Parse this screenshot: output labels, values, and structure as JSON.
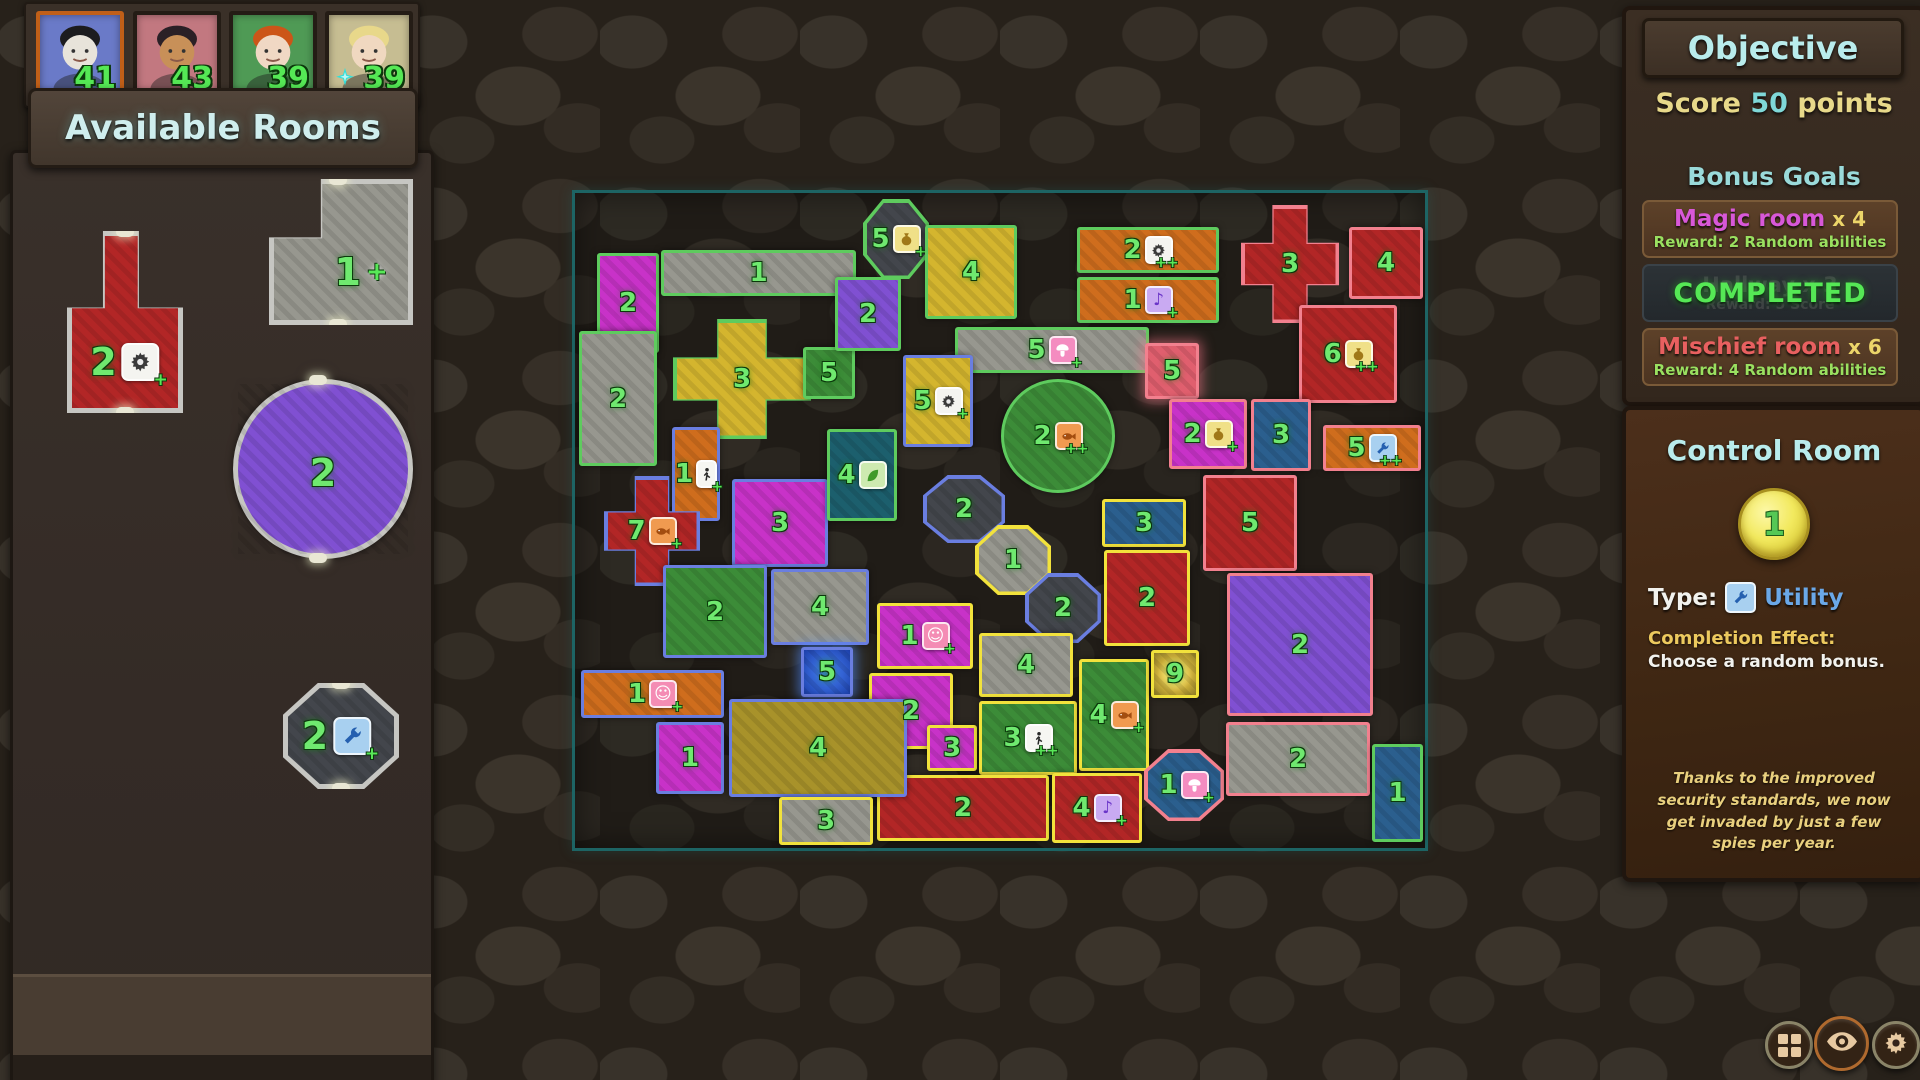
{
  "palette": {
    "floor": {
      "magenta": "#c832c8",
      "gray": "#97978f",
      "yellow": "#d4b52e",
      "treasure": "#a8922a",
      "green": "#3c8c38",
      "orange": "#cf6d1d",
      "red": "#b22626",
      "blue": "#2b5f8e",
      "teal": "#1c5f6d",
      "purple": "#8050d2",
      "dark": "#43464c",
      "pinkGlow": "#e05f6e",
      "blueGlow": "#2a5fd8",
      "gold": "#a08c2a"
    },
    "border": {
      "green": "#5ecb5e",
      "blue": "#6a7ee0",
      "yellow": "#f2e23c",
      "pink": "#f2808e",
      "gray": "#c6c6c2",
      "map": "#1d6464"
    },
    "number": "#6fe96f"
  },
  "hud": {
    "players": [
      {
        "label": "player-1",
        "score": "41",
        "bg": "#6a7ac8",
        "hair": "#1c1c1e",
        "skin": "#e8e4da",
        "frame": "#c05f18",
        "active": true,
        "turn_icon": ""
      },
      {
        "label": "player-2",
        "score": "43",
        "bg": "#c27880",
        "hair": "#2a2026",
        "skin": "#c89058",
        "frame": "#241c15",
        "active": false,
        "turn_icon": ""
      },
      {
        "label": "player-3",
        "score": "39",
        "bg": "#4f9a55",
        "hair": "#cc5518",
        "skin": "#f0d8c4",
        "frame": "#241c15",
        "active": false,
        "turn_icon": ""
      },
      {
        "label": "player-4",
        "score": "39",
        "bg": "#c6bd92",
        "hair": "#e8d88a",
        "skin": "#f0d8c0",
        "frame": "#241c15",
        "active": false,
        "turn_icon": "turn-star"
      }
    ]
  },
  "available_rooms": {
    "title": "Available Rooms",
    "rooms": [
      {
        "shape": "tshape",
        "floor": "red",
        "num": "2",
        "icon": "gear",
        "plus": "+",
        "x": 64,
        "y": 228,
        "w": 116,
        "h": 182,
        "lx": 50,
        "ly": 72
      },
      {
        "shape": "lshape",
        "floor": "gray",
        "num": "1",
        "icon": "plus",
        "plus": "",
        "x": 266,
        "y": 176,
        "w": 144,
        "h": 146,
        "lx": 64,
        "ly": 64
      },
      {
        "shape": "circle",
        "floor": "purple",
        "num": "2",
        "icon": "",
        "plus": "",
        "x": 230,
        "y": 376,
        "w": 180,
        "h": 180,
        "lx": 50,
        "ly": 52
      },
      {
        "shape": "octagon",
        "floor": "dark",
        "num": "2",
        "icon": "wrench",
        "plus": "+",
        "x": 280,
        "y": 680,
        "w": 116,
        "h": 106,
        "lx": 46,
        "ly": 50
      }
    ]
  },
  "objective": {
    "title": "Objective",
    "score_goal": [
      {
        "text": "Score ",
        "color": "#e8d98a"
      },
      {
        "text": "50",
        "color": "#7fd8d8"
      },
      {
        "text": " points",
        "color": "#e8d98a"
      }
    ],
    "bonus_title": "Bonus Goals",
    "goals": [
      {
        "type": "goal",
        "name": "Magic room",
        "name_color": "#d858d8",
        "count": "x 4",
        "reward": "Reward: 2 Random abilities"
      },
      {
        "type": "completed",
        "label": "COMPLETED",
        "ghost_name": "Hallway x 3",
        "ghost_reward": "Reward: 5 Score"
      },
      {
        "type": "goal",
        "name": "Mischief room",
        "name_color": "#e86060",
        "count": "x 6",
        "reward": "Reward: 4 Random abilities"
      }
    ]
  },
  "control_room": {
    "title": "Control Room",
    "level": "1",
    "type_label": "Type:",
    "type_icon": "wrench",
    "type_value": "Utility",
    "effect_label": "Completion Effect:",
    "effect_text": "Choose a random bonus.",
    "flavor": "Thanks to the improved security standards, we now get invaded by just a few spies per year."
  },
  "toolbar": {
    "buttons": [
      {
        "icon": "grid",
        "label": "rooms-grid-button",
        "ring": "#8a8468",
        "x": 1765,
        "y": 1021,
        "d": 48
      },
      {
        "icon": "eye",
        "label": "vision-button",
        "ring": "#b06a2e",
        "x": 1814,
        "y": 1016,
        "d": 55
      },
      {
        "icon": "gear",
        "label": "settings-button",
        "ring": "#8a8468",
        "x": 1872,
        "y": 1021,
        "d": 48
      }
    ]
  },
  "map": {
    "rooms": [
      {
        "n": "2",
        "x": 22,
        "y": 60,
        "w": 62,
        "h": 100,
        "f": "magenta",
        "b": "green",
        "s": "rect",
        "i": "",
        "p": ""
      },
      {
        "n": "1",
        "x": 86,
        "y": 57,
        "w": 195,
        "h": 46,
        "f": "gray",
        "b": "green",
        "s": "rect",
        "i": "",
        "p": ""
      },
      {
        "n": "2",
        "x": 4,
        "y": 138,
        "w": 78,
        "h": 135,
        "f": "gray",
        "b": "green",
        "s": "rect",
        "i": "",
        "p": ""
      },
      {
        "n": "3",
        "x": 98,
        "y": 126,
        "w": 138,
        "h": 120,
        "f": "yellow",
        "b": "green",
        "s": "cross",
        "i": "",
        "p": ""
      },
      {
        "n": "5",
        "x": 228,
        "y": 154,
        "w": 52,
        "h": 52,
        "f": "green",
        "b": "green",
        "s": "rect",
        "i": "",
        "p": ""
      },
      {
        "n": "2",
        "x": 260,
        "y": 84,
        "w": 66,
        "h": 74,
        "f": "purple",
        "b": "green",
        "s": "rect",
        "i": "",
        "p": ""
      },
      {
        "n": "5",
        "x": 288,
        "y": 6,
        "w": 66,
        "h": 80,
        "f": "dark",
        "b": "green",
        "s": "octagon",
        "i": "pot",
        "p": "+"
      },
      {
        "n": "4",
        "x": 350,
        "y": 32,
        "w": 92,
        "h": 94,
        "f": "yellow",
        "b": "green",
        "s": "rect",
        "i": "",
        "p": ""
      },
      {
        "n": "2",
        "x": 502,
        "y": 34,
        "w": 142,
        "h": 46,
        "f": "orange",
        "b": "green",
        "s": "rect",
        "i": "gear",
        "p": "++"
      },
      {
        "n": "1",
        "x": 502,
        "y": 84,
        "w": 142,
        "h": 46,
        "f": "orange",
        "b": "green",
        "s": "rect",
        "i": "music",
        "p": "+"
      },
      {
        "n": "5",
        "x": 380,
        "y": 134,
        "w": 194,
        "h": 46,
        "f": "gray",
        "b": "green",
        "s": "rect",
        "i": "mushroom",
        "p": "+"
      },
      {
        "n": "2",
        "x": 426,
        "y": 186,
        "w": 114,
        "h": 114,
        "f": "green",
        "b": "green",
        "s": "circle",
        "i": "fish",
        "p": "++"
      },
      {
        "n": "5",
        "x": 328,
        "y": 162,
        "w": 70,
        "h": 92,
        "f": "yellow",
        "b": "blue",
        "s": "rect",
        "i": "gear",
        "p": "+"
      },
      {
        "n": "5",
        "x": 570,
        "y": 150,
        "w": 54,
        "h": 56,
        "f": "pinkGlow",
        "b": "pink",
        "s": "rect",
        "i": "",
        "p": ""
      },
      {
        "n": "3",
        "x": 666,
        "y": 12,
        "w": 98,
        "h": 118,
        "f": "red",
        "b": "pink",
        "s": "cross",
        "i": "",
        "p": ""
      },
      {
        "n": "4",
        "x": 774,
        "y": 34,
        "w": 74,
        "h": 72,
        "f": "red",
        "b": "pink",
        "s": "rect",
        "i": "",
        "p": ""
      },
      {
        "n": "6",
        "x": 724,
        "y": 112,
        "w": 98,
        "h": 98,
        "f": "red",
        "b": "pink",
        "s": "rect",
        "i": "pot",
        "p": "++"
      },
      {
        "n": "2",
        "x": 594,
        "y": 206,
        "w": 78,
        "h": 70,
        "f": "magenta",
        "b": "pink",
        "s": "rect",
        "i": "pot",
        "p": "+"
      },
      {
        "n": "3",
        "x": 676,
        "y": 206,
        "w": 60,
        "h": 72,
        "f": "blue",
        "b": "pink",
        "s": "rect",
        "i": "",
        "p": ""
      },
      {
        "n": "5",
        "x": 748,
        "y": 232,
        "w": 98,
        "h": 46,
        "f": "orange",
        "b": "pink",
        "s": "rect",
        "i": "wrench",
        "p": "++"
      },
      {
        "n": "5",
        "x": 628,
        "y": 282,
        "w": 94,
        "h": 96,
        "f": "red",
        "b": "pink",
        "s": "rect",
        "i": "",
        "p": ""
      },
      {
        "n": "2",
        "x": 652,
        "y": 380,
        "w": 146,
        "h": 143,
        "f": "purple",
        "b": "pink",
        "s": "rect",
        "i": "",
        "p": ""
      },
      {
        "n": "2",
        "x": 348,
        "y": 282,
        "w": 82,
        "h": 68,
        "f": "dark",
        "b": "blue",
        "s": "octagon",
        "i": "",
        "p": ""
      },
      {
        "n": "1",
        "x": 400,
        "y": 332,
        "w": 76,
        "h": 70,
        "f": "gray",
        "b": "yellow",
        "s": "octagon",
        "i": "",
        "p": ""
      },
      {
        "n": "2",
        "x": 450,
        "y": 380,
        "w": 76,
        "h": 70,
        "f": "dark",
        "b": "blue",
        "s": "octagon",
        "i": "",
        "p": ""
      },
      {
        "n": "1",
        "x": 302,
        "y": 410,
        "w": 96,
        "h": 66,
        "f": "magenta",
        "b": "yellow",
        "s": "rect",
        "i": "smiley",
        "p": "+"
      },
      {
        "n": "2",
        "x": 294,
        "y": 480,
        "w": 84,
        "h": 76,
        "f": "magenta",
        "b": "yellow",
        "s": "rect",
        "i": "",
        "p": ""
      },
      {
        "n": "3",
        "x": 352,
        "y": 532,
        "w": 50,
        "h": 46,
        "f": "magenta",
        "b": "yellow",
        "s": "rect",
        "i": "",
        "p": ""
      },
      {
        "n": "4",
        "x": 404,
        "y": 440,
        "w": 94,
        "h": 64,
        "f": "gray",
        "b": "yellow",
        "s": "rect",
        "i": "",
        "p": ""
      },
      {
        "n": "3",
        "x": 404,
        "y": 508,
        "w": 98,
        "h": 74,
        "f": "green",
        "b": "yellow",
        "s": "rect",
        "i": "person",
        "p": "++"
      },
      {
        "n": "4",
        "x": 504,
        "y": 466,
        "w": 70,
        "h": 112,
        "f": "green",
        "b": "yellow",
        "s": "rect",
        "i": "fish",
        "p": "+"
      },
      {
        "n": "2",
        "x": 302,
        "y": 582,
        "w": 172,
        "h": 66,
        "f": "red",
        "b": "yellow",
        "s": "rect",
        "i": "",
        "p": ""
      },
      {
        "n": "4",
        "x": 477,
        "y": 580,
        "w": 90,
        "h": 70,
        "f": "red",
        "b": "yellow",
        "s": "rect",
        "i": "music",
        "p": "+"
      },
      {
        "n": "3",
        "x": 527,
        "y": 306,
        "w": 84,
        "h": 48,
        "f": "blue",
        "b": "yellow",
        "s": "rect",
        "i": "",
        "p": ""
      },
      {
        "n": "2",
        "x": 529,
        "y": 357,
        "w": 86,
        "h": 96,
        "f": "red",
        "b": "yellow",
        "s": "rect",
        "i": "",
        "p": ""
      },
      {
        "n": "9",
        "x": 576,
        "y": 457,
        "w": 48,
        "h": 48,
        "f": "gold",
        "b": "yellow",
        "s": "rect",
        "i": "",
        "p": ""
      },
      {
        "n": "1",
        "x": 97,
        "y": 234,
        "w": 48,
        "h": 94,
        "f": "orange",
        "b": "blue",
        "s": "rect",
        "i": "person",
        "p": "+"
      },
      {
        "n": "7",
        "x": 29,
        "y": 283,
        "w": 96,
        "h": 110,
        "f": "red",
        "b": "blue",
        "s": "cross",
        "i": "fish",
        "p": "+"
      },
      {
        "n": "3",
        "x": 157,
        "y": 286,
        "w": 96,
        "h": 88,
        "f": "magenta",
        "b": "blue",
        "s": "rect",
        "i": "",
        "p": ""
      },
      {
        "n": "4",
        "x": 252,
        "y": 236,
        "w": 70,
        "h": 92,
        "f": "teal",
        "b": "green",
        "s": "rect",
        "i": "leaf",
        "p": ""
      },
      {
        "n": "2",
        "x": 88,
        "y": 372,
        "w": 104,
        "h": 93,
        "f": "green",
        "b": "blue",
        "s": "rect",
        "i": "",
        "p": ""
      },
      {
        "n": "4",
        "x": 196,
        "y": 376,
        "w": 98,
        "h": 76,
        "f": "gray",
        "b": "blue",
        "s": "rect",
        "i": "",
        "p": ""
      },
      {
        "n": "5",
        "x": 226,
        "y": 454,
        "w": 52,
        "h": 50,
        "f": "blueGlow",
        "b": "blue",
        "s": "rect",
        "i": "",
        "p": ""
      },
      {
        "n": "1",
        "x": 6,
        "y": 477,
        "w": 143,
        "h": 48,
        "f": "orange",
        "b": "blue",
        "s": "rect",
        "i": "smiley",
        "p": "+"
      },
      {
        "n": "1",
        "x": 81,
        "y": 529,
        "w": 68,
        "h": 72,
        "f": "magenta",
        "b": "blue",
        "s": "rect",
        "i": "",
        "p": ""
      },
      {
        "n": "4",
        "x": 154,
        "y": 506,
        "w": 178,
        "h": 98,
        "f": "treasure",
        "b": "blue",
        "s": "rect",
        "i": "",
        "p": ""
      },
      {
        "n": "3",
        "x": 204,
        "y": 604,
        "w": 94,
        "h": 48,
        "f": "gray",
        "b": "yellow",
        "s": "rect",
        "i": "",
        "p": ""
      },
      {
        "n": "1",
        "x": 569,
        "y": 556,
        "w": 80,
        "h": 72,
        "f": "blue",
        "b": "pink",
        "s": "octagon",
        "i": "mushroom",
        "p": "+"
      },
      {
        "n": "2",
        "x": 651,
        "y": 529,
        "w": 144,
        "h": 74,
        "f": "gray",
        "b": "pink",
        "s": "rect",
        "i": "",
        "p": ""
      },
      {
        "n": "1",
        "x": 797,
        "y": 551,
        "w": 51,
        "h": 98,
        "f": "blue",
        "b": "green",
        "s": "rect",
        "i": "",
        "p": ""
      }
    ]
  }
}
